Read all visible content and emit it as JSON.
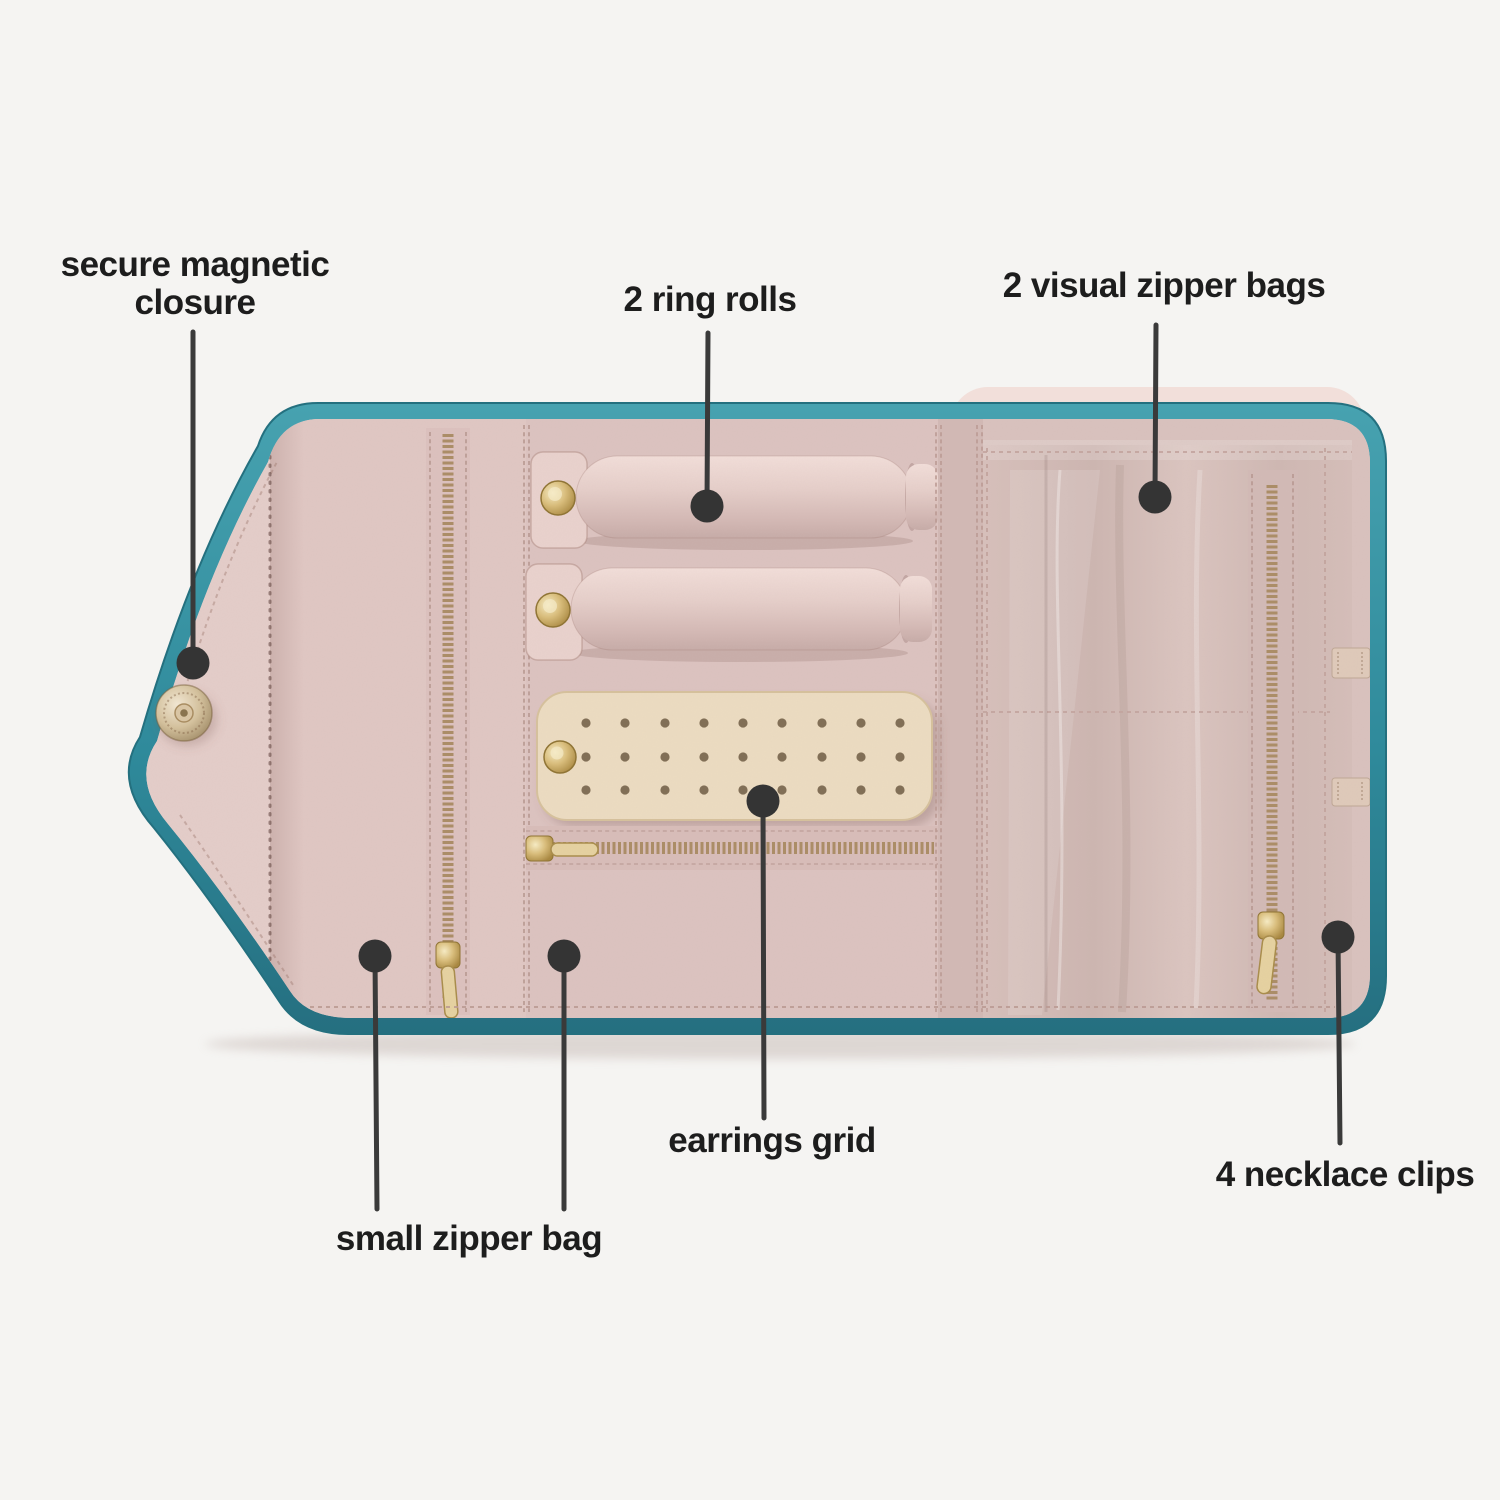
{
  "annotations": {
    "magnetic_closure": {
      "label": "secure magnetic closure"
    },
    "ring_rolls": {
      "label": "2 ring rolls"
    },
    "visual_zipper_bags": {
      "label": "2 visual zipper bags"
    },
    "earrings_grid": {
      "label": "earrings grid"
    },
    "small_zipper_bag": {
      "label": "small zipper bag"
    },
    "necklace_clips": {
      "label": "4 necklace clips"
    }
  },
  "colors": {
    "background": "#f5f4f2",
    "trim_teal": "#2f8a9b",
    "fabric_pink": "#e3cbc7",
    "lining_taupe": "#d0b9b4",
    "grid_cream": "#ecdcc1",
    "hardware_gold": "#c9a85e",
    "stitch": "#b79890",
    "annotation_ink": "#3a3a3a",
    "label_text": "#1d1d1d"
  }
}
